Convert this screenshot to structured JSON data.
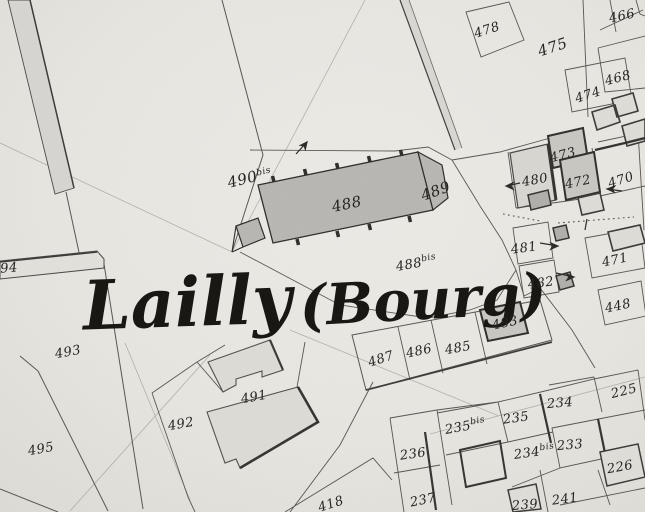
{
  "map": {
    "title": {
      "name": "Lailly",
      "suffix": "(Bourg)"
    },
    "labels": {
      "p478": "478",
      "p475": "475",
      "p466": "466",
      "p468": "468",
      "p474": "474",
      "p473": "473",
      "p480": "480",
      "p472": "472",
      "p470": "470",
      "p481": "481",
      "p471": "471",
      "p482": "482",
      "p448": "448",
      "p489": "489",
      "p488": "488",
      "p490": "490",
      "p490_sup": "bis",
      "p488b": "488",
      "p488b_sup": "bis",
      "p483": "483",
      "p485": "485",
      "p486": "486",
      "p487": "487",
      "p494": "94",
      "p493": "493",
      "p495": "495",
      "p492": "492",
      "p491": "491",
      "p418": "418",
      "p236": "236",
      "p237": "237",
      "p235b": "235",
      "p235b_sup": "bis",
      "p235": "235",
      "p234": "234",
      "p234b": "234",
      "p234b_sup": "bis",
      "p233": "233",
      "p226": "226",
      "p225": "225",
      "p241": "241",
      "p239": "239"
    },
    "icons": {
      "west_arrow": "left-arrow",
      "east_arrow": "right-arrow",
      "north_east_arrow": "up-right-arrow"
    },
    "colors": {
      "paper": "#e9e7e2",
      "ink": "#2f2d2a",
      "church_fill": "#b8b7b3",
      "building_fill": "#c8c7c2",
      "light_building_fill": "#dedcd6",
      "road_fill": "#d8d7d2"
    }
  }
}
